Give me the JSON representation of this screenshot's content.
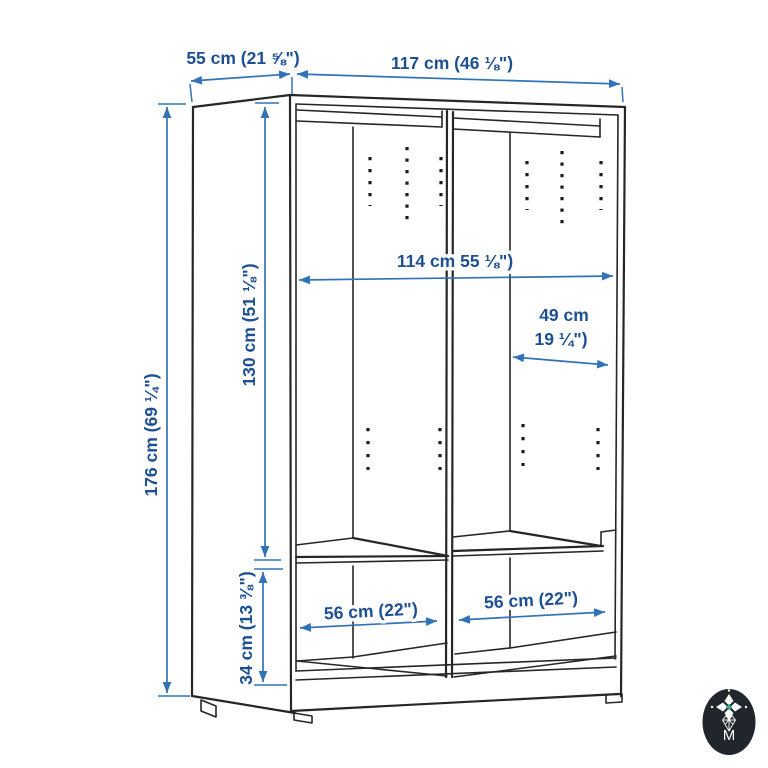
{
  "diagram": {
    "dimensions": {
      "depth": "55 cm (21 ⅝\")",
      "width": "117 cm (46 ⅛\")",
      "height": "176 cm (69 ¼\")",
      "interior_height": "130 cm (51 ⅛\")",
      "interior_width": "114 cm 55 ⅛\")",
      "compartment_width_line1": "49 cm",
      "compartment_width_line2": "19 ¼\")",
      "shelf_width_left": "56 cm (22\")",
      "shelf_width_right": "56 cm (22\")",
      "base_height": "34 cm (13 ⅜\")"
    },
    "colors": {
      "background": "#ffffff",
      "drawing_line": "#262626",
      "dimension_line": "#3273b8",
      "dimension_text": "#1c4f93",
      "logo_background": "#20262c",
      "logo_foreground": "#ffffff",
      "logo_accent_teal": "#2fa58d"
    },
    "logo": {
      "letter": "M"
    }
  }
}
